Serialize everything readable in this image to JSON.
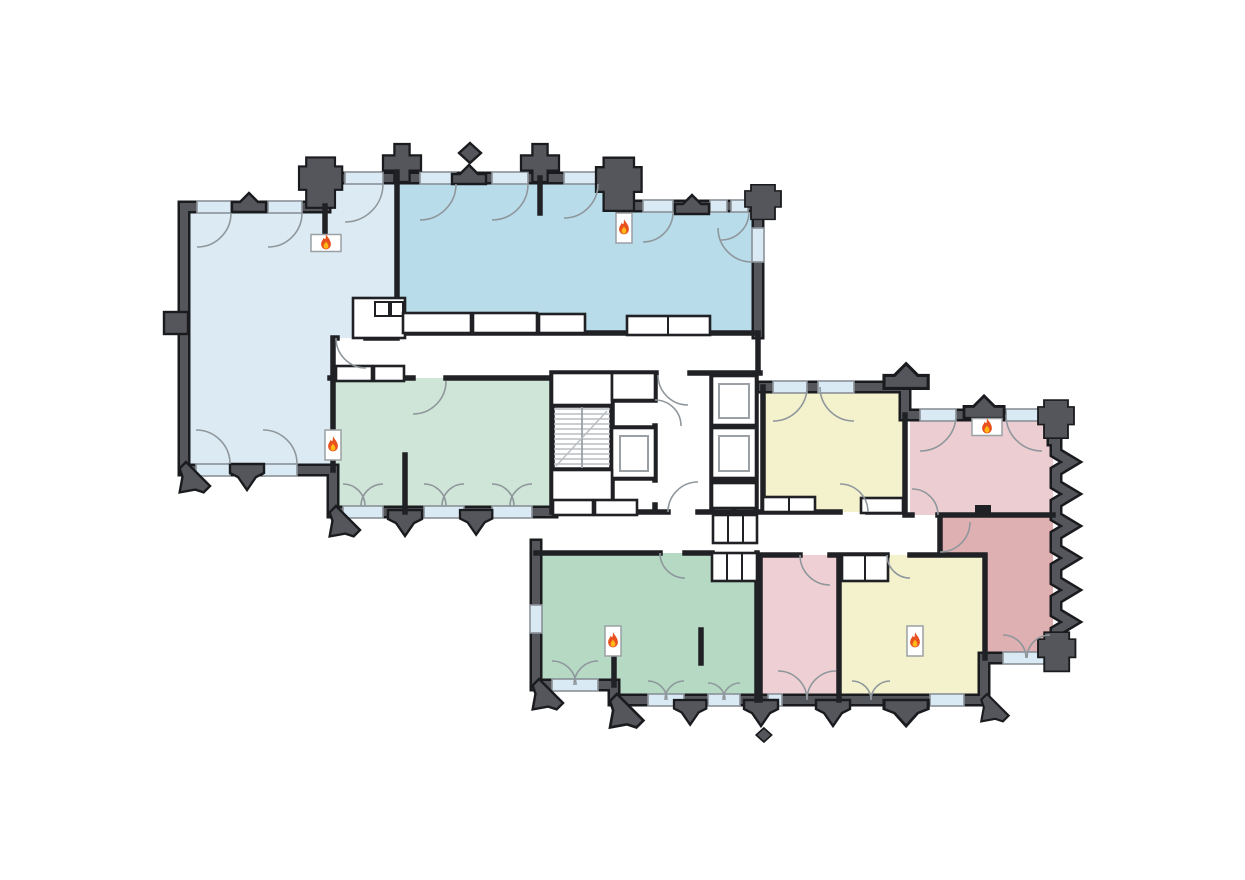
{
  "page": {
    "title": "Building floor plan with fire markers",
    "background": "#ffffff",
    "visible_text": []
  },
  "palette": {
    "exterior_wall": "#54565b",
    "wall_outline": "#1a1b1e",
    "interior_wall": "#202124",
    "window_glass": "#d9eaf5",
    "window_frame": "#8a9197",
    "door_arc": "#8f979c",
    "stair_lines": "#b9bec2",
    "fixture_outline": "#9aa0a4",
    "flame_outer": "#e8501e",
    "flame_inner": "#fdb717",
    "marker_box": "#ffffff"
  },
  "rooms": [
    {
      "id": "nw-large",
      "name": "large room north-west",
      "color": "#dcebf3",
      "has_fire_marker": true
    },
    {
      "id": "nw-second",
      "name": "second room north",
      "color": "#b8dcea",
      "has_fire_marker": true
    },
    {
      "id": "mid-green",
      "name": "green room centre-west",
      "color": "#cfe5d7",
      "has_fire_marker": true
    },
    {
      "id": "mid-yellow",
      "name": "yellow room centre-east",
      "color": "#f3f2cd",
      "has_fire_marker": false
    },
    {
      "id": "ne-pink",
      "name": "pink room north-east",
      "color": "#ecced2",
      "has_fire_marker": true
    },
    {
      "id": "east-red",
      "name": "dark pink room east",
      "color": "#dfb0b2",
      "has_fire_marker": false
    },
    {
      "id": "s-green",
      "name": "green room south",
      "color": "#b5d9c3",
      "has_fire_marker": true
    },
    {
      "id": "s-pink",
      "name": "pink room south",
      "color": "#eed0d4",
      "has_fire_marker": false
    },
    {
      "id": "s-yellow",
      "name": "yellow room south",
      "color": "#f3f2cc",
      "has_fire_marker": true
    }
  ],
  "core": {
    "staircases": 1,
    "elevators": 3
  },
  "fire_markers": [
    {
      "room": "nw-large",
      "x": 326,
      "y": 243,
      "orientation": "horizontal"
    },
    {
      "room": "nw-second",
      "x": 624,
      "y": 228,
      "orientation": "vertical"
    },
    {
      "room": "mid-green",
      "x": 333,
      "y": 445,
      "orientation": "vertical"
    },
    {
      "room": "ne-pink",
      "x": 987,
      "y": 427,
      "orientation": "horizontal"
    },
    {
      "room": "s-green",
      "x": 613,
      "y": 641,
      "orientation": "vertical"
    },
    {
      "room": "s-yellow",
      "x": 915,
      "y": 641,
      "orientation": "vertical"
    }
  ]
}
